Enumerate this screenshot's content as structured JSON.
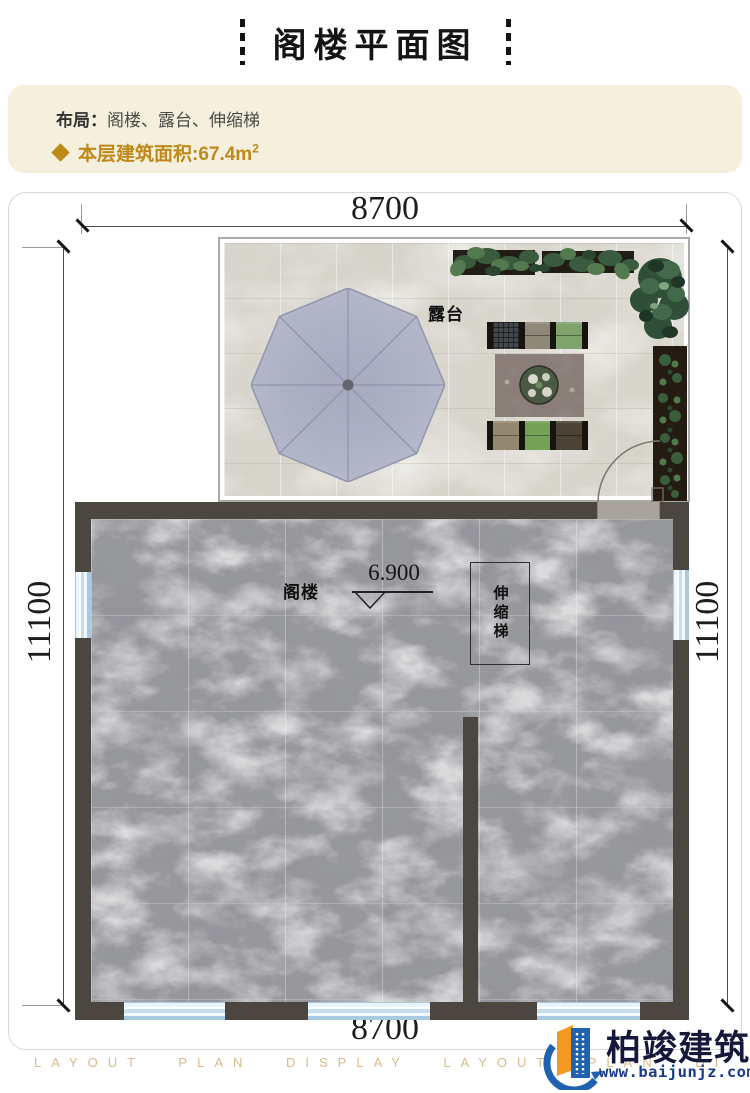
{
  "header": {
    "title": "阁楼平面图"
  },
  "info": {
    "layout_label": "布局：",
    "layout_value": "阁楼、露台、伸缩梯",
    "area_label": "本层建筑面积:",
    "area_value": "67.4m",
    "area_sup": "2",
    "accent_color": "#bd8a1a",
    "box_color": "#f5efdd"
  },
  "plan": {
    "dims": {
      "top": "8700",
      "bottom": "8700",
      "left": "11100",
      "right": "11100"
    },
    "labels": {
      "terrace": "露台",
      "attic": "阁楼",
      "level": "6.900",
      "ladder": "伸缩梯"
    },
    "colors": {
      "wall": "#4b463f",
      "window": "#cfe4f3",
      "marble_floor": "#97989c",
      "terrace_stone": "#d8d5cc",
      "umbrella": "#aeb1c7"
    }
  },
  "footer": {
    "watermark": "LAYOUT PLAN DISPLAY LAYOUT PLAN DI",
    "brand": "柏竣建筑",
    "website": "www.baijunjz.com",
    "brand_color": "#15183a",
    "icon_blue": "#1f63b0",
    "icon_orange": "#f59a20"
  }
}
